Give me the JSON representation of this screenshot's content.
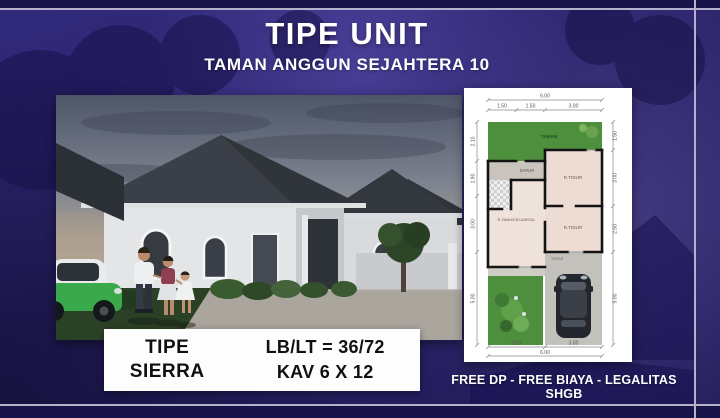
{
  "header": {
    "title": "TIPE UNIT",
    "subtitle": "TAMAN ANGGUN SEJAHTERA 10"
  },
  "info_box": {
    "type_label": "TIPE",
    "type_name": "SIERRA",
    "size": "LB/LT = 36/72",
    "kav": "KAV 6 X 12"
  },
  "footer": {
    "promo": "FREE DP - FREE BIAYA - LEGALITAS SHGB"
  },
  "floorplan": {
    "dims": {
      "top_total": "6.00",
      "top": [
        "1.50",
        "1.50",
        "3.00"
      ],
      "left": [
        "2.10",
        "1.90",
        "3.00",
        "5.00"
      ],
      "right": [
        "1.50",
        "3.00",
        "2.50",
        "5.00"
      ],
      "bottom": [
        "3.00",
        "3.00"
      ],
      "bottom_total": "6.00"
    },
    "rooms": {
      "garden": "TAMAN",
      "kitchen": "DAPUR",
      "bedroom1": "R.TIDUR",
      "bedroom2": "R.TIDUR",
      "living": "R.TAMU/KELUARGA",
      "porch": "TERAS"
    }
  },
  "colors": {
    "background_navy": "#2a2368",
    "frame_lavender": "#b7b0cb",
    "title_white": "#ffffff",
    "plan_garden_green": "#4e8f3e",
    "plan_room_pink": "#ecdcd4",
    "plan_concrete_gray": "#c3c1bc",
    "plan_wall_black": "#141414",
    "car_green": "#3aa94b"
  }
}
